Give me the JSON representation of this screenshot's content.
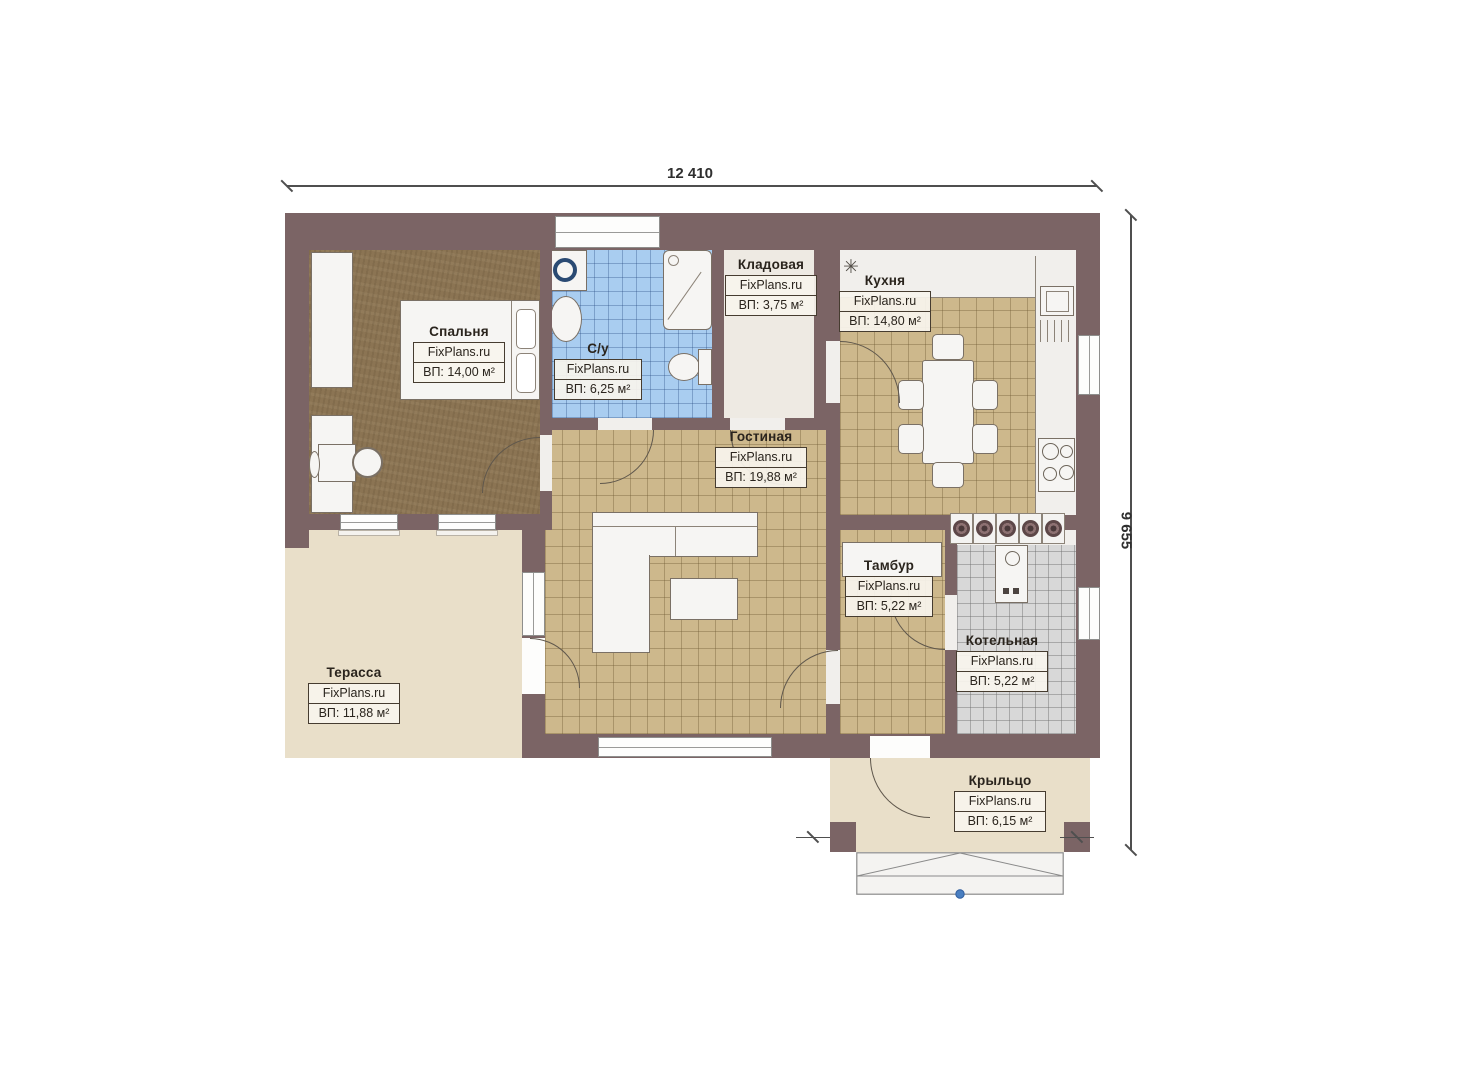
{
  "plan": {
    "type": "floor-plan",
    "dimensions": {
      "width_label": "12 410",
      "height_label": "9 655"
    },
    "brand": "FixPlans.ru"
  },
  "rooms": [
    {
      "id": "bedroom",
      "name": "Спальня",
      "brand": "FixPlans.ru",
      "area": "ВП: 14,00 м²"
    },
    {
      "id": "bathroom",
      "name": "С/у",
      "brand": "FixPlans.ru",
      "area": "ВП: 6,25 м²"
    },
    {
      "id": "storage",
      "name": "Кладовая",
      "brand": "FixPlans.ru",
      "area": "ВП: 3,75 м²"
    },
    {
      "id": "kitchen",
      "name": "Кухня",
      "brand": "FixPlans.ru",
      "area": "ВП: 14,80 м²"
    },
    {
      "id": "living",
      "name": "Гостиная",
      "brand": "FixPlans.ru",
      "area": "ВП: 19,88 м²"
    },
    {
      "id": "tambour",
      "name": "Тамбур",
      "brand": "FixPlans.ru",
      "area": "ВП: 5,22 м²"
    },
    {
      "id": "boiler",
      "name": "Котельная",
      "brand": "FixPlans.ru",
      "area": "ВП: 5,22 м²"
    },
    {
      "id": "terrace",
      "name": "Терасса",
      "brand": "FixPlans.ru",
      "area": "ВП: 11,88 м²"
    },
    {
      "id": "porch",
      "name": "Крыльцо",
      "brand": "FixPlans.ru",
      "area": "ВП: 6,15 м²"
    }
  ],
  "icons": {
    "ventilation": "✳"
  },
  "colors": {
    "wall": "#7b6465",
    "tile_tan": "#cdb88c",
    "tile_blue": "#a9cdf0",
    "tile_gray": "#d8d8d8",
    "wood_floor": "#8b7453",
    "outdoor": "#e9dfc9",
    "marker_dot": "#4a7fc1"
  }
}
